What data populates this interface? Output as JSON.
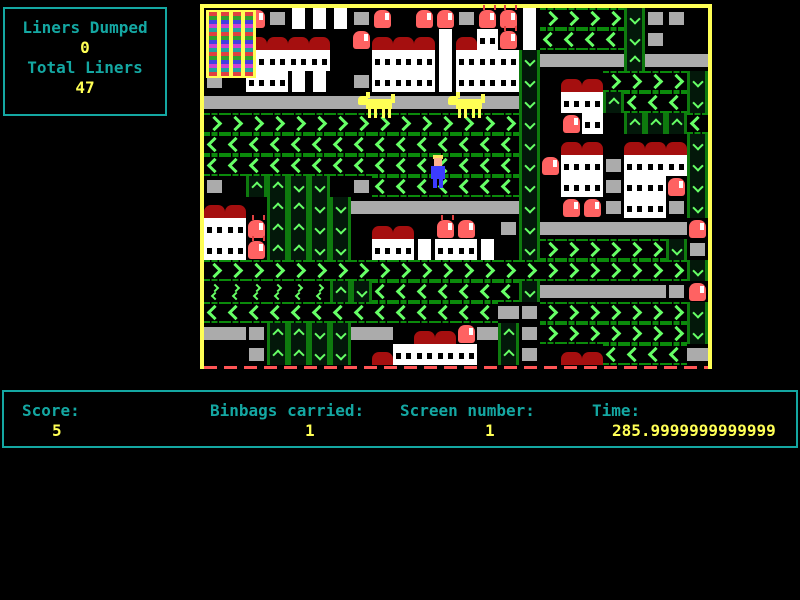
{
  "hud": {
    "liners_box": {
      "label1": "Liners Dumped",
      "value1": "0",
      "label2": "Total Liners",
      "value2": "47"
    },
    "status_bar": {
      "fields": [
        {
          "label": "Score:",
          "value": "5"
        },
        {
          "label": "Binbags carried:",
          "value": "1"
        },
        {
          "label": "Screen number:",
          "value": "1"
        },
        {
          "label": "Time:",
          "value": "285.9999999999999"
        }
      ]
    }
  },
  "board": {
    "tile_size": 21,
    "cols": 24,
    "rows": 17,
    "legend": {
      ">": "arrow-right",
      "<": "arrow-left",
      "^": "arrow-up",
      "v": "arrow-down",
      "=": "conveyor-belt",
      "g": "conveyor-segment",
      "w": "house-windows",
      "W": "house-plain",
      "C": "white-column",
      "r": "house-roof",
      "B": "red-bin",
      "b": "red-bin-with-flies",
      "F": "yellow-flats",
      "m": "mini-double-arrow",
      ".": "empty"
    },
    "grid": [
      "FFBgCCCgB.BBgbbC>>>>vgg.",
      "FFrrrr.BrrrCrwbC<<<<vg..",
      "FFwwww..wwwCwwwv====^===",
      "g.wwCC.gwwwCwwwv.rr>>>>v",
      "===============v.ww^<<<v",
      ">>>>>>>>>>>>>>>v.Bw.^^^<",
      "<<<<<<<<<<<<<<<v.rr.rrrv",
      "<<<<<<<<<<<<<<<vBwwgwwwv",
      "g.^^vv.g<<<<<<<v.wwgwwBv",
      "rr.^^vv========v.BBgwwgv",
      "wwb^^vv.rr.bB.gv=======B",
      "wwb^^vv.wwCwwC.v>>>>>>vg",
      ">>>>>>>>>>>>>>>>>>>>>>>v",
      "mmmmmm^v<<<<<<<v======gB",
      "<<<<<<<<<<<<<<=g>>>>>>>v",
      "==g^^vv==.rrB=^g>>>>>>>v",
      "..g^^vv.rwwww.^g.rr<<<<="
    ],
    "entities": [
      {
        "type": "flats",
        "x": 2,
        "y": 2,
        "w": 50,
        "h": 68
      },
      {
        "type": "dog",
        "x": 154,
        "y": 84,
        "w": 40,
        "h": 26
      },
      {
        "type": "dog",
        "x": 244,
        "y": 84,
        "w": 40,
        "h": 26
      },
      {
        "type": "player",
        "x": 225,
        "y": 147,
        "w": 18,
        "h": 33
      }
    ]
  },
  "colors": {
    "hud_text": "#14a7a2",
    "hud_value": "#ffff55",
    "arrow_bright_green": "#66ff66",
    "arrow_dark_green": "#0b8a0b",
    "conveyor_gray": "#ababab",
    "roof_red": "#a50f0f",
    "bin_red": "#ff6262",
    "border_yellow": "#ffff55",
    "background": "#000000"
  }
}
